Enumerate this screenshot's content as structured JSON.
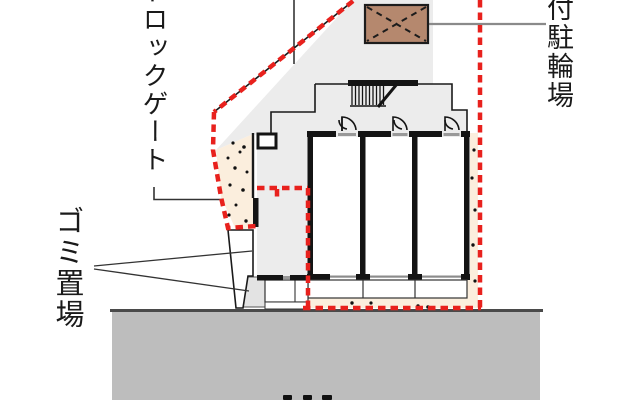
{
  "labels": {
    "auto_lock_gate": "トロックゲート",
    "covered_bicycle_parking": "付駐輪場",
    "garbage_storage": "ゴミ置場"
  },
  "colors": {
    "boundary_red": "#e8211d",
    "site_gray": "#ececec",
    "road_gray": "#bdbdbd",
    "road_edge": "#4a4a4a",
    "approach_beige": "#fbeedd",
    "canopy_brown": "#b5886e",
    "wall_black": "#141414",
    "leader_gray": "#8a8a8a",
    "sill_gray": "#999999"
  },
  "plan": {
    "dwelling_units_visible": 3,
    "boundary_style": "red dashed",
    "bottom_cutoff_marks": 3
  }
}
